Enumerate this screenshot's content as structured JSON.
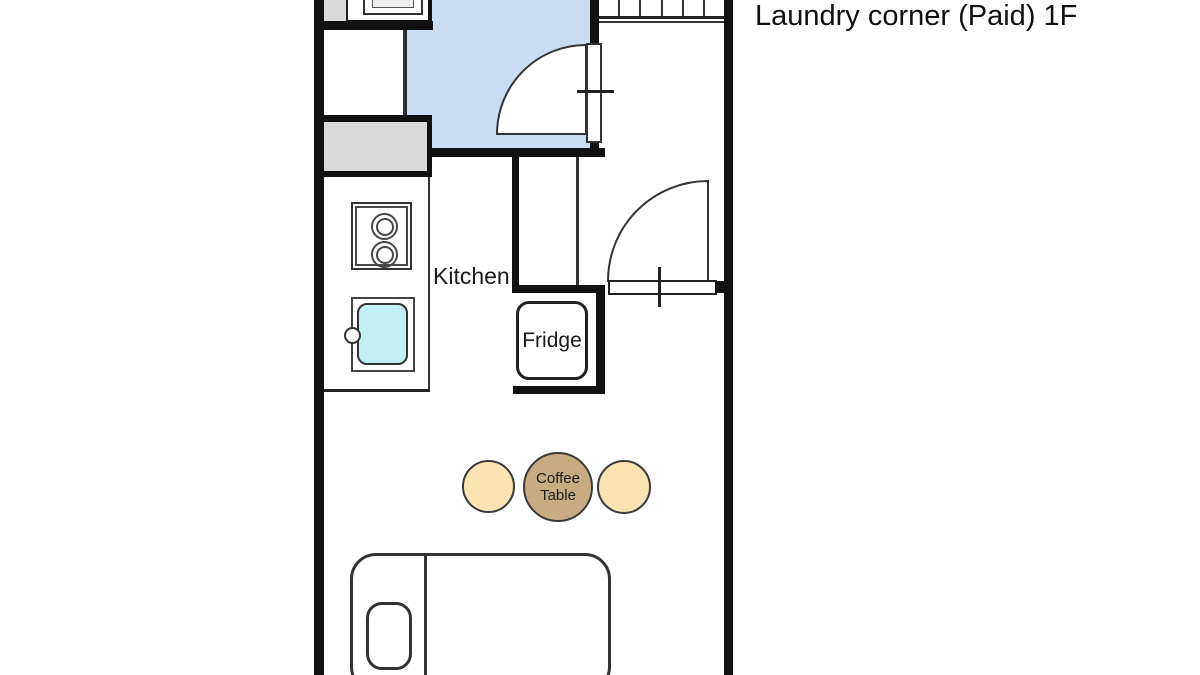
{
  "title": "Laundry corner (Paid) 1F",
  "labels": {
    "kitchen": "Kitchen",
    "fridge": "Fridge",
    "coffee_line1": "Coffee",
    "coffee_line2": "Table"
  },
  "colors": {
    "wall": "#111111",
    "line": "#333333",
    "text": "#1a1a1a",
    "room_blue": "#c9dcf4",
    "grey": "#d9d9d9",
    "sink_cyan": "#c2eff4",
    "table_tan": "#c8ab83",
    "chair_cream": "#fce3b4"
  }
}
